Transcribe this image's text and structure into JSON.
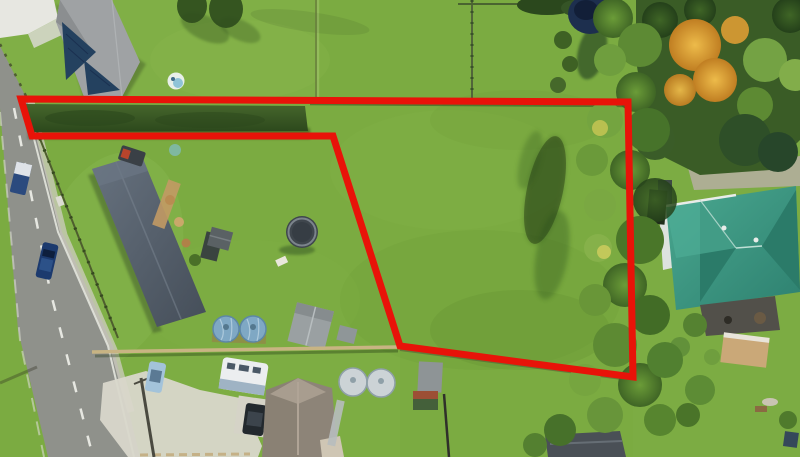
{
  "meta": {
    "type": "aerial-photograph",
    "description": "Aerial drone photo of a suburban vacant land parcel outlined with a red boundary line, flag-shaped lot with access strip along a hedge, neighbouring houses, road at left, mature trees at right",
    "width": 800,
    "height": 457
  },
  "annotation": {
    "boundary": {
      "points": "21,99 628,102 633,377 400,346 333,136 32,136",
      "color": "#e81309",
      "stroke_width": "7"
    }
  },
  "palette": {
    "grass_base": "#7bab41",
    "grass_light": "#8cb854",
    "grass_dark": "#649231",
    "road": "#8f918b",
    "road_marking": "#f0f1ea",
    "footpath": "#cfcdc0",
    "driveway": "#d9d7cb",
    "hedge": "#3c5c25",
    "slate_roof": "#5b6673",
    "gray_roof": "#9fa2a4",
    "navy_panels": "#24415f",
    "brown_roof": "#8d8478",
    "brown_roof_light": "#a89d8f",
    "teal_roof": "#3f9e89",
    "teal_roof_dark": "#2b7b69",
    "navy_tree": "#1d2f4e",
    "tree_orange": "#dd9c34",
    "tank_blue": "#7fa8c4",
    "tank_gray": "#ccd3d6",
    "caravan": "#eceef0",
    "trampoline": "#3f464d",
    "pergola": "#caa878",
    "fence_tan": "#c8b483"
  },
  "scene": {
    "objects": [
      {
        "name": "red-boundary-outline",
        "note": "flag-shaped parcel outline"
      },
      {
        "name": "road",
        "note": "diagonal street lower-left with dashed centerline and footpath"
      },
      {
        "name": "top-left-house",
        "note": "gray hip roof with dark navy panels"
      },
      {
        "name": "main-house",
        "note": "long slate roof, center-left"
      },
      {
        "name": "bottom-house",
        "note": "brown-gray hip roof at bottom center"
      },
      {
        "name": "teal-house",
        "note": "large teal cross-hip roof at right"
      },
      {
        "name": "hedge-strip",
        "note": "dark hedge inside boundary access strip"
      },
      {
        "name": "tree-column",
        "note": "mature trees along right side of parcel"
      },
      {
        "name": "orange-tree",
        "note": "autumn-coloured tree top right"
      },
      {
        "name": "navy-tree",
        "note": "dark tree at top centre"
      },
      {
        "name": "blue-water-tanks",
        "note": "two pale blue tanks"
      },
      {
        "name": "gray-water-tanks",
        "note": "two light gray tanks"
      },
      {
        "name": "trampoline",
        "note": "dark round trampoline in lawn"
      },
      {
        "name": "paddling-pool",
        "note": "small light pool in top yard"
      },
      {
        "name": "caravan",
        "note": "white caravan near bottom house"
      },
      {
        "name": "cars",
        "note": "blue car and van on road, light blue car and dark car on driveways"
      },
      {
        "name": "sheds",
        "note": "gray garden sheds, dark shed bottom centre, green playhouse"
      },
      {
        "name": "pergola",
        "note": "tan pergola right side"
      },
      {
        "name": "fences",
        "note": "timber fences between yards and along road"
      }
    ]
  }
}
